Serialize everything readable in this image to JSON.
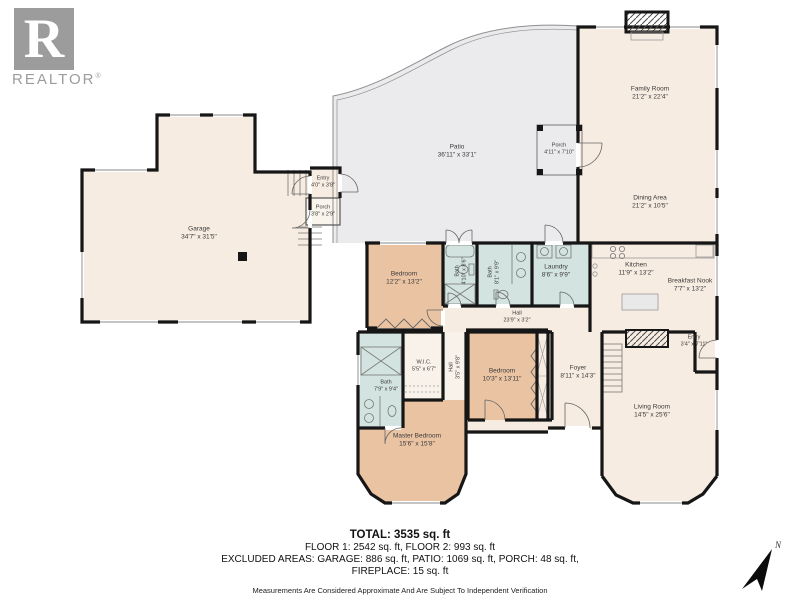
{
  "branding": {
    "logo_letter": "R",
    "logo_text": "REALTOR",
    "trademark": "®"
  },
  "compass": {
    "label": "N"
  },
  "colors": {
    "wall": "#161616",
    "floor_cream": "#f7ece1",
    "floor_tan": "#eac3a3",
    "floor_blue": "#d3e4e0",
    "floor_patio_gray": "#ebebed",
    "logo_gray": "#9c9c9c",
    "label_text": "#3a3a3a"
  },
  "rooms": {
    "garage": {
      "name": "Garage",
      "dims": "34'7\" x 31'5\""
    },
    "entry_garage": {
      "name": "Entry",
      "dims": "4'0\" x 3'8\""
    },
    "porch_garage": {
      "name": "Porch",
      "dims": "3'8\" x 2'9\""
    },
    "patio": {
      "name": "Patio",
      "dims": "36'11\" x 33'1\""
    },
    "porch_patio": {
      "name": "Porch",
      "dims": "4'11\" x 7'10\""
    },
    "family_room": {
      "name": "Family Room",
      "dims": "21'2\" x 22'4\""
    },
    "dining_area": {
      "name": "Dining Area",
      "dims": "21'2\" x 10'5\""
    },
    "kitchen": {
      "name": "Kitchen",
      "dims": "11'9\" x 13'2\""
    },
    "breakfast_nook": {
      "name": "Breakfast Nook",
      "dims": "7'7\" x 13'2\""
    },
    "laundry": {
      "name": "Laundry",
      "dims": "8'6\" x 9'9\""
    },
    "bath_hall": {
      "name": "Bath",
      "dims": "4'10\" x 8'6\""
    },
    "bath_double": {
      "name": "Bath",
      "dims": "8'1\" x 9'9\""
    },
    "bedroom_upper": {
      "name": "Bedroom",
      "dims": "12'2\" x 13'2\""
    },
    "hall": {
      "name": "Hall",
      "dims": "23'9\" x 3'2\""
    },
    "hall_small": {
      "name": "Hall",
      "dims": "3'5\" x 9'8\""
    },
    "wic": {
      "name": "W.I.C.",
      "dims": "5'5\" x 6'7\""
    },
    "bath_master": {
      "name": "Bath",
      "dims": "7'9\" x 9'4\""
    },
    "master_bedroom": {
      "name": "Master Bedroom",
      "dims": "15'6\" x 15'8\""
    },
    "bedroom_right": {
      "name": "Bedroom",
      "dims": "10'3\" x 13'11\""
    },
    "foyer": {
      "name": "Foyer",
      "dims": "8'11\" x 14'3\""
    },
    "entry_main": {
      "name": "Entry",
      "dims": "3'4\" x 7'11\""
    },
    "living_room": {
      "name": "Living Room",
      "dims": "14'5\" x 25'6\""
    }
  },
  "summary": {
    "total": "TOTAL: 3535 sq. ft",
    "floors": "FLOOR 1: 2542 sq. ft, FLOOR 2: 993 sq. ft",
    "excluded_line1": "EXCLUDED AREAS: GARAGE: 886 sq. ft, PATIO: 1069 sq. ft, PORCH: 48 sq. ft,",
    "excluded_line2": "FIREPLACE: 15 sq. ft",
    "disclaimer": "Measurements Are Considered Approximate And Are Subject To Independent Verification"
  }
}
